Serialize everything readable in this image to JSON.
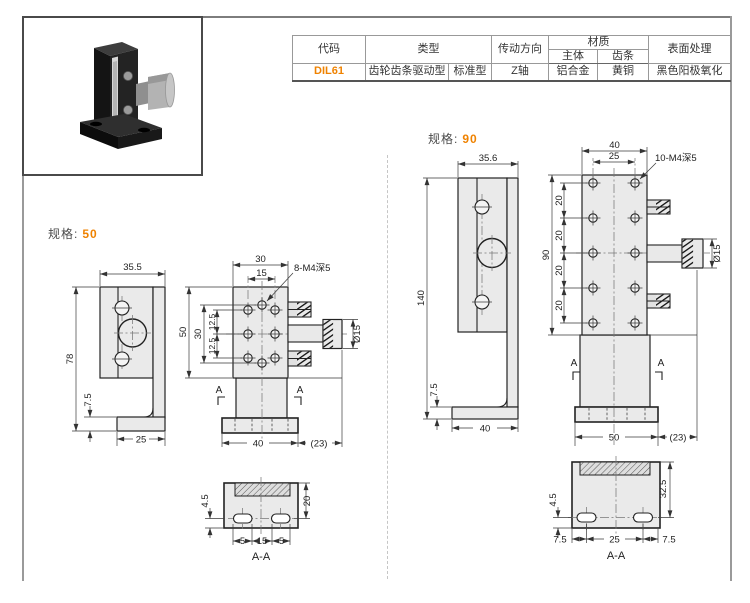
{
  "colors": {
    "accent": "#ef8200"
  },
  "table": {
    "col_code": "代码",
    "col_type": "类型",
    "col_direction": "传动方向",
    "col_material": "材质",
    "col_material_body": "主体",
    "col_material_rack": "齿条",
    "col_surface": "表面处理",
    "row": {
      "code": "DIL61",
      "type_main": "齿轮齿条驱动型",
      "type_sub": "标准型",
      "direction": "Z轴",
      "material_body": "铝合金",
      "material_rack": "黄铜",
      "surface": "黑色阳极氧化"
    }
  },
  "spec50": {
    "label": "规格:",
    "value": "50",
    "dims": {
      "side_width": "35.5",
      "side_height": "78",
      "side_base_h": "7.5",
      "side_base_w": "25",
      "top_w": "30",
      "top_holes": "15",
      "holes_label": "8-M4深5",
      "height": "50",
      "span": "30",
      "pitch_a": "12.5",
      "pitch_b": "12.5",
      "knob_dia": "Ø15",
      "base_w": "40",
      "knob_len": "(23)",
      "sec_mark": "A"
    },
    "section": {
      "h_top": "20",
      "h_bottom": "4.5",
      "w_left": "5",
      "w_mid": "15",
      "w_right": "5",
      "label": "A-A"
    }
  },
  "spec90": {
    "label": "规格:",
    "value": "90",
    "dims": {
      "side_width": "35.6",
      "side_height": "140",
      "side_base_h": "7.5",
      "side_base_w": "40",
      "top_w": "40",
      "top_holes": "25",
      "holes_label": "10-M4深5",
      "height": "90",
      "pitch": "20",
      "knob_dia": "Ø15",
      "base_w": "50",
      "knob_len": "(23)",
      "sec_mark": "A"
    },
    "section": {
      "h_top": "32.5",
      "h_bottom": "4.5",
      "w_left": "7.5",
      "w_mid": "25",
      "w_right": "7.5",
      "label": "A-A"
    }
  }
}
